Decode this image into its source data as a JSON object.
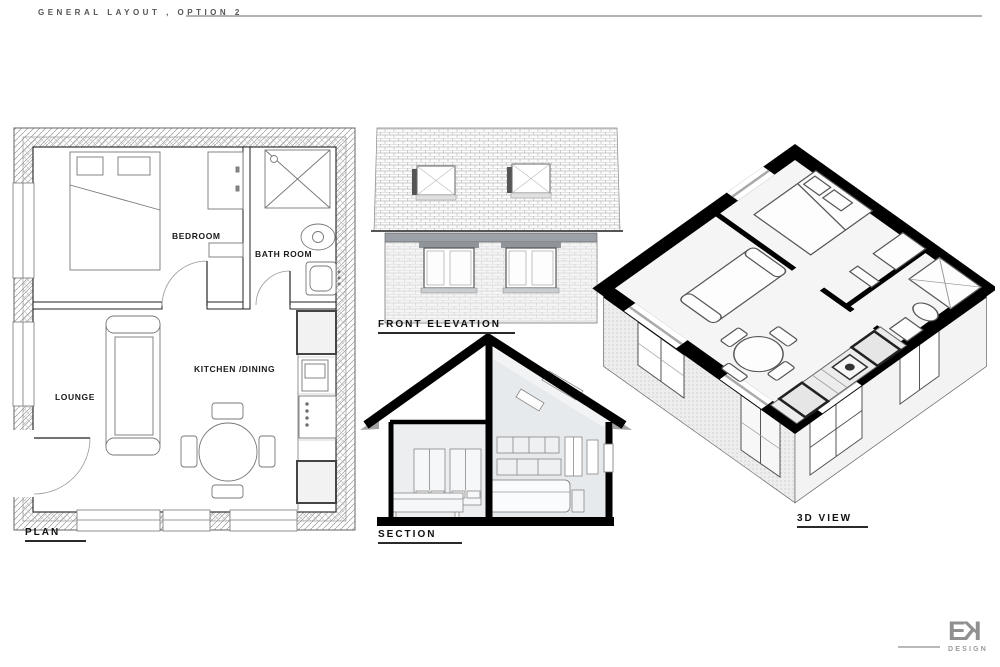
{
  "sheet": {
    "title": "GENERAL LAYOUT , OPTION 2"
  },
  "drawings": {
    "plan": {
      "label": "PLAN",
      "rooms": {
        "bedroom": "BEDROOM",
        "bathroom": "BATH ROOM",
        "lounge": "LOUNGE",
        "kitchen_dining": "KITCHEN /DINING"
      }
    },
    "front_elevation": {
      "label": "FRONT ELEVATION"
    },
    "section": {
      "label": "SECTION"
    },
    "view_3d": {
      "label": "3D VIEW"
    }
  },
  "logo": {
    "letter_e": "E",
    "letter_k": "K",
    "sub": "DESIGN"
  },
  "palette": {
    "paper": "#ffffff",
    "ink": "#1a1a1a",
    "wall_black": "#000000",
    "rule_gray": "#b3b3b3",
    "logo_gray": "#909090",
    "brick_band": "#9ba1a6"
  }
}
